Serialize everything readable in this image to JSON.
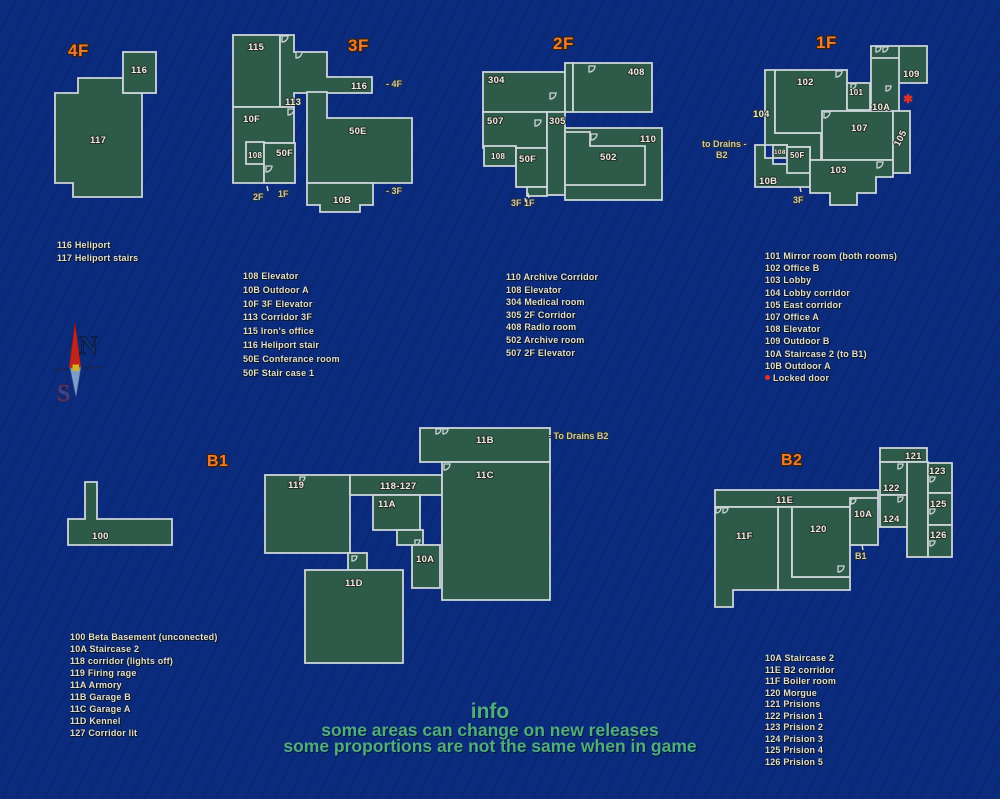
{
  "colors": {
    "background": "#0b2c7e",
    "room_fill": "#2d5a49",
    "room_stroke": "#ccd5d9",
    "floor_title": "#ee7c31",
    "label": "#ece9dd",
    "info_green": "#50ae7d",
    "locked_red": "#e23222"
  },
  "compass": {
    "n": "N",
    "s": "S"
  },
  "info": {
    "title": "info",
    "line1": "some areas can change on new releases",
    "line2": "some proportions are not the same when in game"
  },
  "floors": {
    "f4": {
      "title": "4F",
      "rooms": {
        "r116": "116",
        "r117": "117"
      },
      "legend": [
        "116 Heliport",
        "117 Heliport stairs"
      ]
    },
    "f3": {
      "title": "3F",
      "rooms": {
        "r115": "115",
        "r113": "113",
        "r116": "116",
        "r10F": "10F",
        "r108": "108",
        "r50F": "50F",
        "r50E": "50E",
        "r10B": "10B"
      },
      "ann": {
        "to4F": "-  4F",
        "e2F": "2F",
        "e1F": "1F",
        "to3F": "- 3F"
      },
      "legend": [
        "108 Elevator",
        "10B Outdoor A",
        "10F 3F Elevator",
        "113 Corridor 3F",
        "115 Iron's office",
        "116 Heliport stair",
        "50E Conferance room",
        "50F Stair case 1"
      ]
    },
    "f2": {
      "title": "2F",
      "rooms": {
        "r304": "304",
        "r408": "408",
        "r507": "507",
        "r305": "305",
        "r108": "108",
        "r50F": "50F",
        "r502": "502",
        "r110": "110"
      },
      "ann": {
        "exit": "3F 1F"
      },
      "legend": [
        "110 Archive Corridor",
        "108 Elevator",
        "304 Medical room",
        "305 2F Corridor",
        "408 Radio room",
        "502 Archive room",
        "507 2F Elevator"
      ]
    },
    "f1": {
      "title": "1F",
      "rooms": {
        "r104": "104",
        "r102": "102",
        "r101": "101",
        "r109": "109",
        "r10A": "10A",
        "r107": "107",
        "r105": "105",
        "r103": "103",
        "r108": "108",
        "r50F": "50F",
        "r10B": "10B"
      },
      "ann": {
        "drains1": "to Drains -",
        "drains2": "B2",
        "exit": "3F",
        "locked": "✱"
      },
      "legend": [
        "101 Mirror room (both rooms)",
        "102 Office B",
        "103 Lobby",
        "104 Lobby corridor",
        "105 East corridor",
        "107 Office A",
        "108 Elevator",
        "109 Outdoor B",
        "10A Staircase 2 (to B1)",
        "10B Outdoor A"
      ],
      "locked_label": "Locked door"
    },
    "b1": {
      "title": "B1",
      "rooms": {
        "r100": "100",
        "r119": "119",
        "r118": "118-127",
        "r11A": "11A",
        "r10A": "10A",
        "r11D": "11D",
        "r11B": "11B",
        "r11C": "11C"
      },
      "ann": {
        "drains": "- To Drains B2"
      },
      "legend": [
        "100 Beta Basement (unconected)",
        "10A Staircase 2",
        "118 corridor (lights off)",
        "119 Firing rage",
        "11A Armory",
        "11B Garage B",
        "11C Garage A",
        "11D Kennel",
        "127 Corridor lit"
      ]
    },
    "b2": {
      "title": "B2",
      "rooms": {
        "r11E": "11E",
        "r11F": "11F",
        "r120": "120",
        "r10A": "10A",
        "r121": "121",
        "r122": "122",
        "r123": "123",
        "r124": "124",
        "r125": "125",
        "r126": "126"
      },
      "ann": {
        "exit": "B1"
      },
      "legend": [
        "10A Staircase 2",
        "11E B2 corridor",
        "11F Boiler room",
        "120 Morgue",
        "121 Prisions",
        "122 Prision 1",
        "123 Prision 2",
        "124 Prision 3",
        "125 Prision 4",
        "126 Prision 5"
      ]
    }
  }
}
